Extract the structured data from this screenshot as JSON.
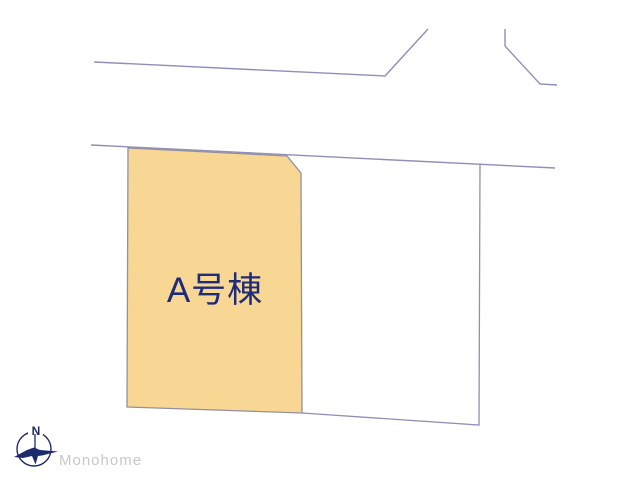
{
  "diagram": {
    "type": "real-estate-lot-layout",
    "background_color": "#ffffff",
    "boundary_line_color": "#8f8fb8",
    "parcels": [
      {
        "id": "A",
        "label": "A号棟",
        "fill_color": "#f8d794",
        "label_color": "#1e2b78"
      },
      {
        "id": "adjacent",
        "fill_color": "#ffffff"
      }
    ]
  },
  "compass": {
    "north_label": "N",
    "color": "#1c2a6e"
  },
  "watermark": {
    "text": "Monohome",
    "color": "#c8c8c8"
  }
}
